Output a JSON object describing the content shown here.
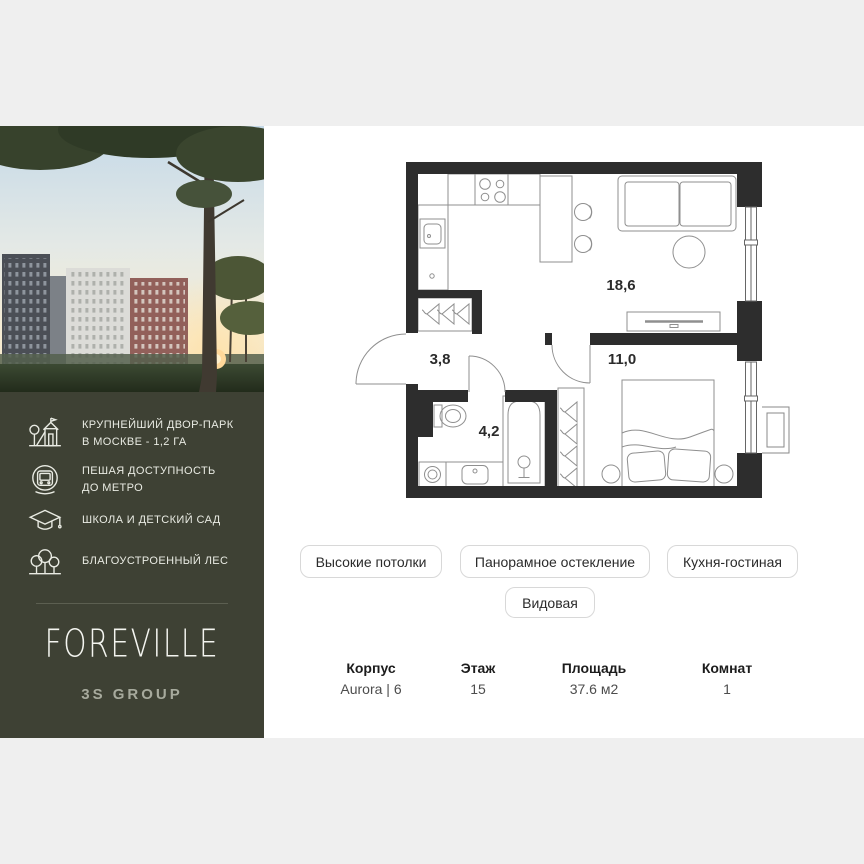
{
  "page": {
    "background": "#efefef",
    "card_background": "#ffffff"
  },
  "brand": {
    "name": "FOREVILLE",
    "developer": "3S GROUP",
    "panel_color": "#3e4134"
  },
  "photo": {
    "alt": "residential towers at sunset behind pine trees"
  },
  "features": [
    {
      "icon": "playground-icon",
      "text_lines": [
        "КРУПНЕЙШИЙ ДВОР-ПАРК",
        "В МОСКВЕ - 1,2 ГА"
      ]
    },
    {
      "icon": "metro-icon",
      "text_lines": [
        "ПЕШАЯ ДОСТУПНОСТЬ",
        "ДО МЕТРО"
      ]
    },
    {
      "icon": "graduation-icon",
      "text_lines": [
        "ШКОЛА И ДЕТСКИЙ САД"
      ]
    },
    {
      "icon": "forest-icon",
      "text_lines": [
        "БЛАГОУСТРОЕННЫЙ ЛЕС"
      ]
    }
  ],
  "floor_plan": {
    "rooms": [
      {
        "name": "kitchen-living",
        "area": "18,6"
      },
      {
        "name": "bedroom",
        "area": "11,0"
      },
      {
        "name": "hallway",
        "area": "3,8"
      },
      {
        "name": "bathroom",
        "area": "4,2"
      }
    ]
  },
  "tags": [
    "Высокие потолки",
    "Панорамное остекление",
    "Кухня-гостиная",
    "Видовая"
  ],
  "details": [
    {
      "label": "Корпус",
      "value": "Aurora | 6"
    },
    {
      "label": "Этаж",
      "value": "15"
    },
    {
      "label": "Площадь",
      "value": "37.6 м2"
    },
    {
      "label": "Комнат",
      "value": "1"
    }
  ]
}
